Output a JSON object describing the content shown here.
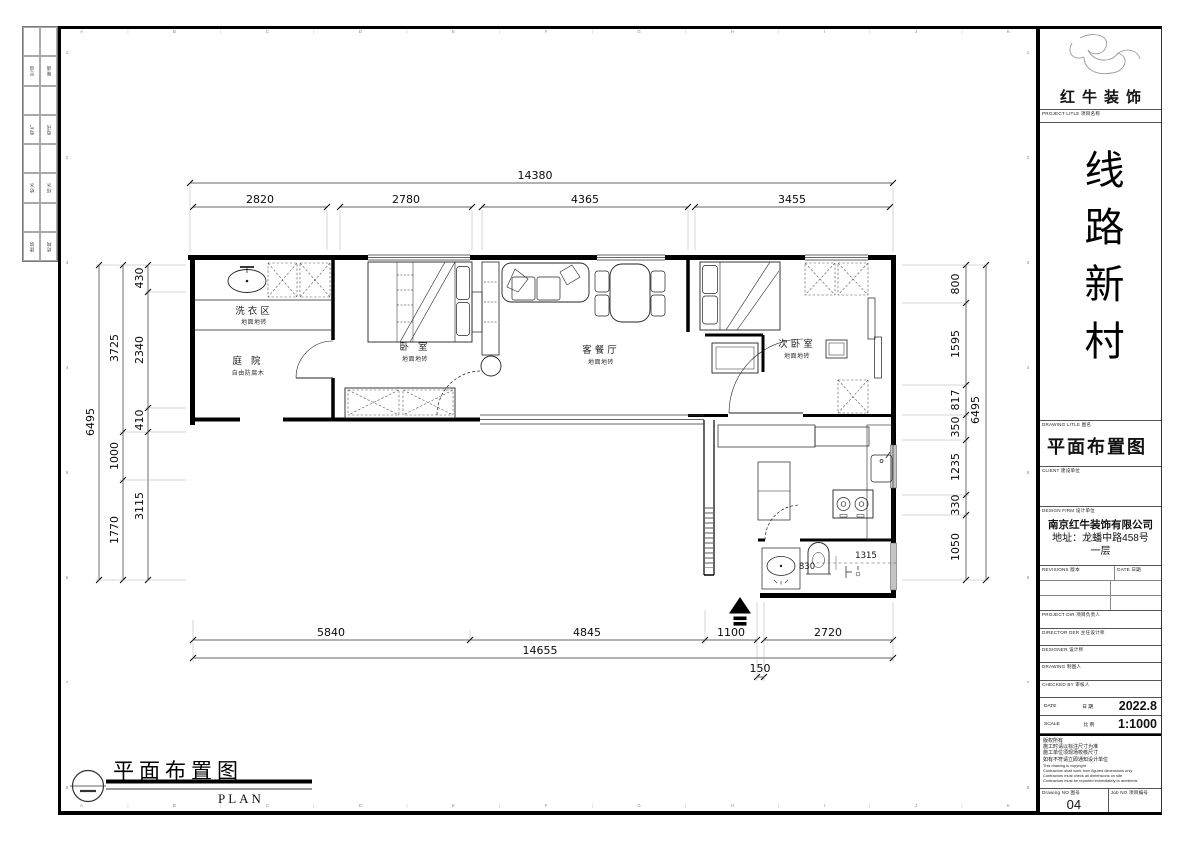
{
  "sheet": {
    "grid_letters": [
      "A",
      "B",
      "C",
      "D",
      "E",
      "F",
      "G",
      "H",
      "I",
      "J",
      "K"
    ],
    "grid_numbers": [
      "1",
      "2",
      "3",
      "4",
      "5",
      "6",
      "7",
      "8"
    ]
  },
  "sign_strip": {
    "rows": [
      [
        "空调",
        "暖通"
      ],
      [
        "电气",
        "电讯"
      ],
      [
        "给水",
        "排水"
      ],
      [
        "建筑",
        "结构"
      ]
    ]
  },
  "title_block": {
    "company": "红牛装饰",
    "project_label": "PROJECT LITLE 项目名称",
    "project_name": "线路新村",
    "drawing_label": "DRAWING LITLE 图名",
    "drawing_title": "平面布置图",
    "client_label": "CLIENT 建设单位",
    "firm_label": "DESIGN FIRM 设计单位",
    "firm_name": "南京红牛装饰有限公司",
    "firm_address": "地址：龙蟠中路458号一层",
    "revisions_label": "REVISIONS 版本",
    "revisions_date_label": "DATE 日期",
    "rows": [
      "PROJECT DIR  项目负责人",
      "DIRECTOR DER 主任设计师",
      "DESIGNER  设计师",
      "DRAWING  制图人",
      "CHECKED BY  审核人"
    ],
    "date_label": "DATE",
    "date_label_cn": "日 期",
    "date_value": "2022.8",
    "scale_label": "SCALE",
    "scale_label_cn": "比 例",
    "scale_value": "1:1000",
    "copyright_lines": [
      "版权所有",
      "施工时请以标注尺寸为准",
      "施工单位须现场校核尺寸",
      "如有不符请立即通知设计单位",
      "This drawing is copyright",
      "Contractors shall work form figured dimensions only",
      "Contractors must check all dimensions on site",
      "Contractors must be reported immediately to architects"
    ],
    "drawing_no_label": "Drawing NO 图号",
    "drawing_no": "04",
    "job_no_label": "Job NO 项目编号"
  },
  "plan": {
    "rooms": [
      {
        "name": "洗衣区",
        "finish": "地面地砖"
      },
      {
        "name": "庭 院",
        "finish": "自由防腐木"
      },
      {
        "name": "卧 室",
        "finish": "地面地砖"
      },
      {
        "name": "客餐厅",
        "finish": "地面地砖"
      },
      {
        "name": "次卧室",
        "finish": "地面地砖"
      }
    ],
    "dims": {
      "top_overall": "14380",
      "top_segments": [
        "2820",
        "2780",
        "4365",
        "3455"
      ],
      "bottom_segments": [
        "5840",
        "4845",
        "1100",
        "2720"
      ],
      "bottom_overall": "14655",
      "bottom_offset": "150",
      "left_overall": "6495",
      "left_mid": [
        "3725",
        "1000",
        "1770"
      ],
      "left_inner": [
        "430",
        "2340",
        "410",
        "3115"
      ],
      "right_overall": "6495",
      "right_inner": [
        "800",
        "1595",
        "817",
        "350",
        "1235",
        "330",
        "1050"
      ],
      "bath": [
        "830",
        "1315"
      ]
    }
  },
  "footer": {
    "title": "平面布置图",
    "subtitle": "PLAN"
  }
}
